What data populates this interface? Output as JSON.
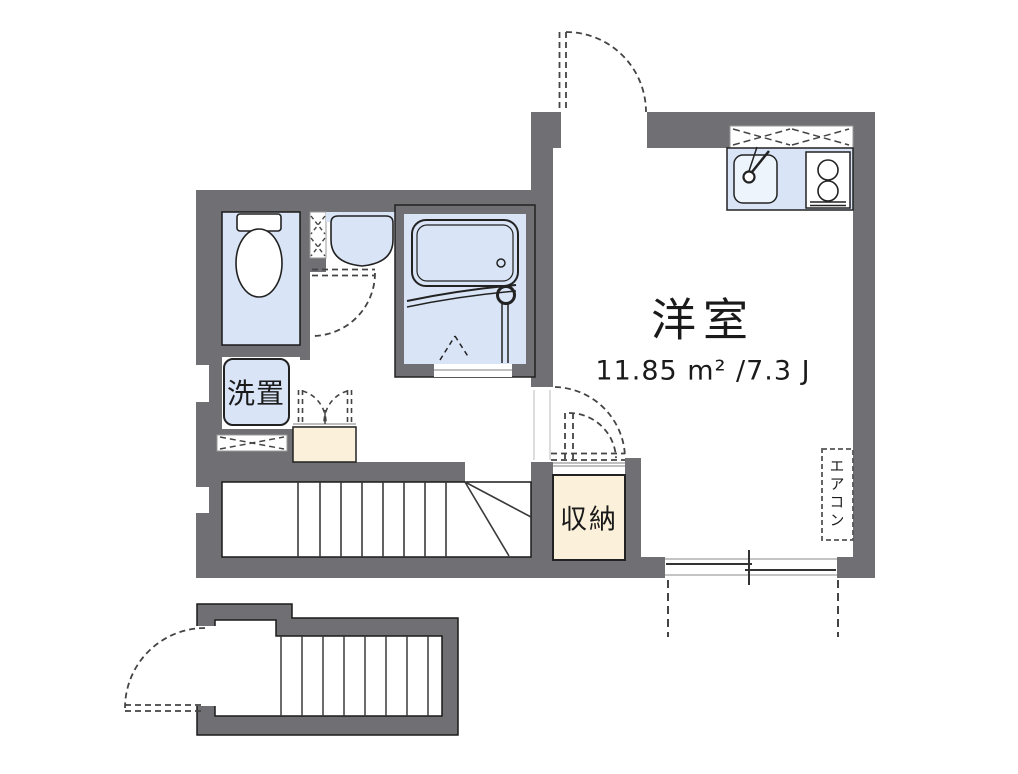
{
  "plan": {
    "room": {
      "name": "洋室",
      "area": "11.85 m² /7.3 J"
    },
    "laundry_label": "洗置",
    "storage_label": "収納",
    "aircon_label": "エアコン"
  },
  "colors": {
    "wall": "#6f6f74",
    "fixture_fill": "#d9e5f7",
    "closet_fill": "#fbf1da",
    "line": "#222222",
    "background": "#ffffff"
  },
  "fixtures": [
    "toilet",
    "washbasin",
    "bathtub",
    "bath-handle",
    "bath-folding-door",
    "kitchen-sink",
    "gas-stove",
    "washer-space",
    "mini-closet",
    "staircase-upper",
    "staircase-lower",
    "storage-closet",
    "entrance-door",
    "sliding-window",
    "air-conditioner",
    "pipe-space-window"
  ]
}
